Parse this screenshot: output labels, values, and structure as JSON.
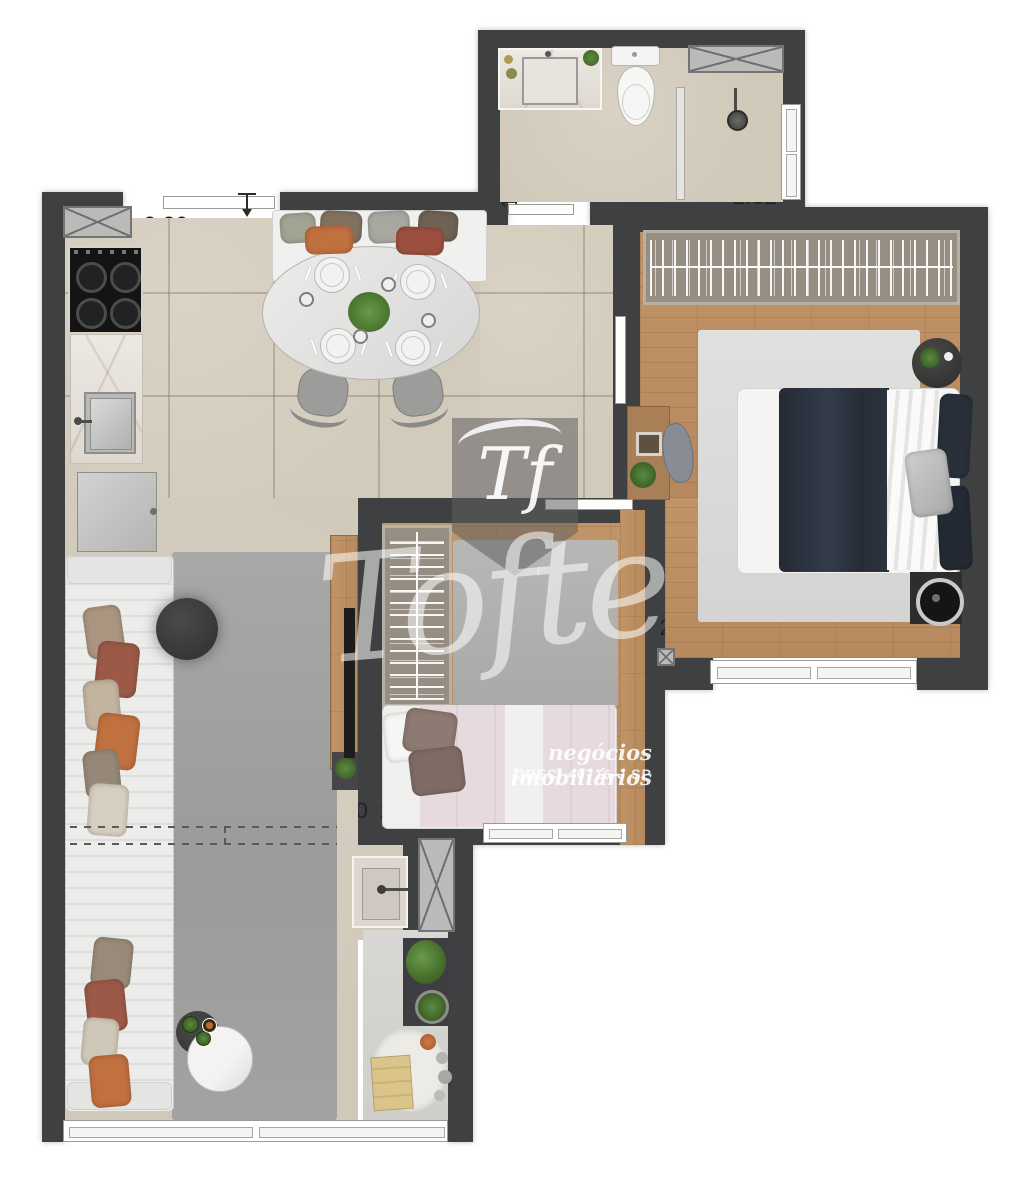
{
  "plan": {
    "labels": {
      "kitchen_width": {
        "text": "2.80"
      },
      "bath_depth": {
        "text": "1.34"
      },
      "shower_width": {
        "text": "2.32"
      },
      "hall_depth": {
        "text": "2.25"
      },
      "bedroom_top_width": {
        "text": "3.60"
      },
      "bedroom_mid_width": {
        "text": "2.60"
      },
      "bedroom_bottom_len": {
        "text": "2.50"
      },
      "living_width": {
        "text": "2.50"
      },
      "bedroom2_width": {
        "text": "2.20"
      },
      "living_length": {
        "text": "7.28"
      },
      "balcony_length": {
        "text": "3.16"
      }
    },
    "watermark": {
      "monogram": "Tf",
      "brand": "Tofte",
      "tagline": "negócios imobiliários",
      "creci": "CRECI 40716-J SP"
    },
    "colors": {
      "wall": "#3f4042",
      "tile_floor": "#d5cec0",
      "wood_floor": "#bd9369",
      "living_rug": "#a2a2a0",
      "bedroom_rug": "#dcdcda",
      "navy_blanket": "#2b313d",
      "pink_bed": "#e5d9dc",
      "accent_orange": "#c1703f",
      "accent_rust": "#9c5948",
      "plant_green": "#4d7a3a"
    }
  }
}
